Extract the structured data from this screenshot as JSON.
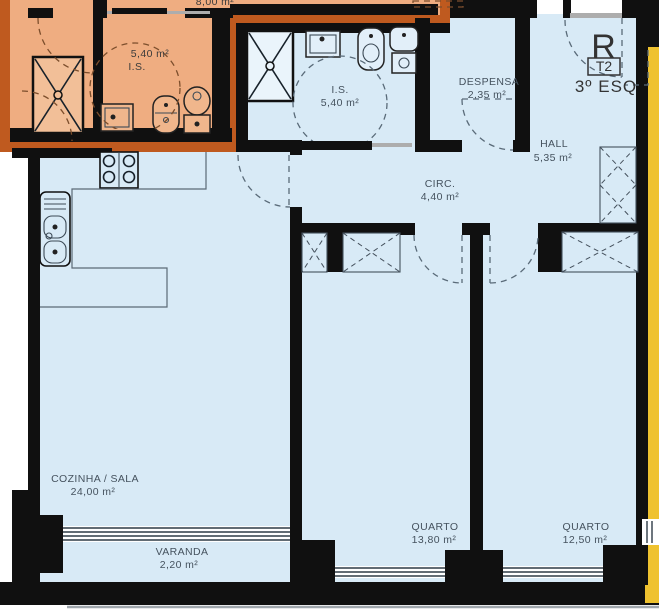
{
  "unit": {
    "mark": "R",
    "type_badge": "T2",
    "floor": "3º ESQ"
  },
  "rooms": {
    "adjacent_is": {
      "area": "5,40 m²",
      "name": "I.S."
    },
    "adjacent_partial": {
      "area": "8,00 m²"
    },
    "is": {
      "name": "I.S.",
      "area": "5,40 m²"
    },
    "despensa": {
      "name": "DESPENSA",
      "area": "2,35 m²"
    },
    "hall": {
      "name": "HALL",
      "area": "5,35 m²"
    },
    "circ": {
      "name": "CIRC.",
      "area": "4,40 m²"
    },
    "cozinha_sala": {
      "name": "COZINHA / SALA",
      "area": "24,00 m²"
    },
    "varanda": {
      "name": "VARANDA",
      "area": "2,20 m²"
    },
    "quarto1": {
      "name": "QUARTO",
      "area": "13,80 m²"
    },
    "quarto2": {
      "name": "QUARTO",
      "area": "12,50 m²"
    }
  },
  "colors": {
    "wall": "#101010",
    "floor_blue": "#D8EAF6",
    "adjacent_fill": "#EFAD81",
    "adjacent_border": "#BF5A1F",
    "adjacent_right_fill": "#EFC22F",
    "label_text": "#45525E",
    "shower_fill_blue": "#EAF4FB",
    "shower_fill_orange": "#F2BF98"
  }
}
